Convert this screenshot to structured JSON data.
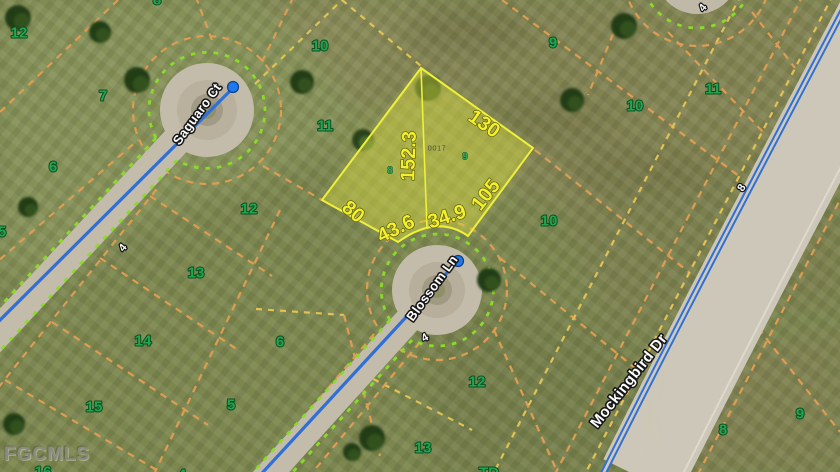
{
  "map": {
    "watermark": "FGCMLS",
    "colors": {
      "lot_label_green": "#21a650",
      "highlight_fill": "#d8dc3e",
      "highlight_stroke": "#eef039",
      "dimension_yellow": "#f4f02c",
      "boundary_dash_orange": "#dd9d52",
      "boundary_dash_yellow": "#e2c254",
      "right_of_way_green_dash": "#8bdb2b",
      "route_blue": "#2f6fd6",
      "road_gray": "#c3bcab"
    },
    "streets": [
      {
        "name": "Saguaro Ct",
        "x": 197,
        "y": 114,
        "rotate": -54,
        "size": "sm"
      },
      {
        "name": "Blossom Ln",
        "x": 432,
        "y": 288,
        "rotate": -54,
        "size": "sm"
      },
      {
        "name": "Mockingbird Dr",
        "x": 629,
        "y": 381,
        "rotate": -52,
        "size": "lg"
      }
    ],
    "highlight": {
      "parcel_number": {
        "value": "0017",
        "x": 437,
        "y": 148
      },
      "dimensions": [
        {
          "value": "130",
          "x": 484,
          "y": 124,
          "rotate": 35
        },
        {
          "value": "152.3",
          "x": 409,
          "y": 156,
          "rotate": -88
        },
        {
          "value": "105",
          "x": 486,
          "y": 195,
          "rotate": -52
        },
        {
          "value": "80",
          "x": 353,
          "y": 212,
          "rotate": 40
        },
        {
          "value": "43.6",
          "x": 396,
          "y": 229,
          "rotate": -26
        },
        {
          "value": "34.9",
          "x": 447,
          "y": 217,
          "rotate": -18
        }
      ],
      "inner_lots": [
        {
          "value": "8",
          "x": 390,
          "y": 171
        },
        {
          "value": "9",
          "x": 465,
          "y": 157
        }
      ]
    },
    "lot_labels": [
      {
        "value": "12",
        "x": 19,
        "y": 33
      },
      {
        "value": "7",
        "x": 103,
        "y": 96
      },
      {
        "value": "6",
        "x": 53,
        "y": 167
      },
      {
        "value": "5",
        "x": 2,
        "y": 232
      },
      {
        "value": "11",
        "x": 325,
        "y": 126
      },
      {
        "value": "12",
        "x": 249,
        "y": 209
      },
      {
        "value": "13",
        "x": 196,
        "y": 273
      },
      {
        "value": "14",
        "x": 143,
        "y": 341
      },
      {
        "value": "15",
        "x": 94,
        "y": 407
      },
      {
        "value": "16",
        "x": 43,
        "y": 472
      },
      {
        "value": "5",
        "x": 231,
        "y": 405
      },
      {
        "value": "6",
        "x": 280,
        "y": 342
      },
      {
        "value": "4",
        "x": 182,
        "y": 475
      },
      {
        "value": "10",
        "x": 320,
        "y": 46
      },
      {
        "value": "9",
        "x": 553,
        "y": 43
      },
      {
        "value": "8",
        "x": 157,
        "y": 0
      },
      {
        "value": "10",
        "x": 635,
        "y": 106
      },
      {
        "value": "11",
        "x": 713,
        "y": 89
      },
      {
        "value": "10",
        "x": 549,
        "y": 221
      },
      {
        "value": "12",
        "x": 477,
        "y": 382
      },
      {
        "value": "13",
        "x": 423,
        "y": 448
      },
      {
        "value": "TD",
        "x": 489,
        "y": 473
      },
      {
        "value": "8",
        "x": 723,
        "y": 430
      },
      {
        "value": "9",
        "x": 800,
        "y": 414
      }
    ],
    "road_markers": [
      {
        "value": "4",
        "x": 123,
        "y": 248,
        "rotate": -50
      },
      {
        "value": "4",
        "x": 425,
        "y": 338,
        "rotate": -30
      },
      {
        "value": "4",
        "x": 703,
        "y": 8,
        "rotate": -50
      },
      {
        "value": "8",
        "x": 742,
        "y": 188,
        "rotate": -58
      }
    ],
    "route_dots": [
      {
        "x": 233,
        "y": 87
      },
      {
        "x": 458,
        "y": 261
      }
    ]
  }
}
